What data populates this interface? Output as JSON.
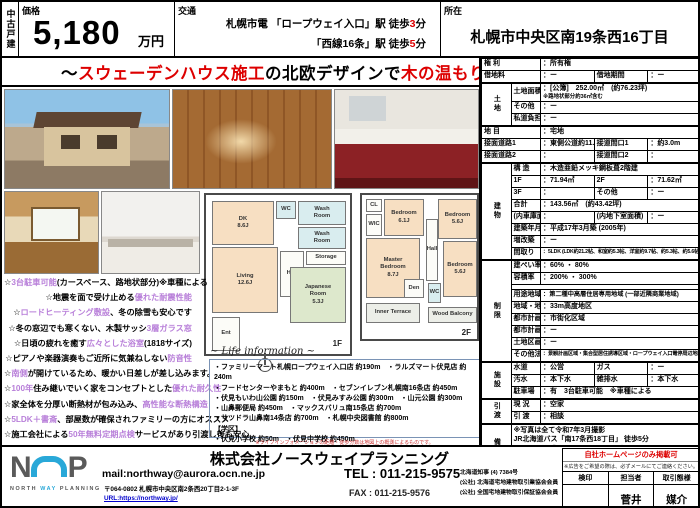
{
  "header": {
    "property_type": "中古戸建",
    "price": {
      "label": "価格",
      "value": "5,180",
      "unit": "万円"
    },
    "access": {
      "label": "交通",
      "lines": [
        [
          [
            "札幌市電 「ロープウェイ入口」駅 徒歩",
            ""
          ],
          [
            "3",
            "r"
          ],
          [
            "分",
            ""
          ]
        ],
        [
          [
            "「西線16条」駅 徒歩",
            ""
          ],
          [
            "5",
            "r"
          ],
          [
            "分",
            ""
          ]
        ]
      ]
    },
    "location": {
      "label": "所在",
      "value": "札幌市中央区南19条西16丁目"
    }
  },
  "banner": [
    [
      "～",
      ""
    ],
    [
      "スウェーデンハウス施工",
      "r"
    ],
    [
      "の北欧デザインで",
      ""
    ],
    [
      "木の温もり",
      "r"
    ],
    [
      "を感じられる邸宅～",
      ""
    ]
  ],
  "floorplan": {
    "f1": {
      "label": "1F",
      "rooms": {
        "dk": "DK\n8.6J",
        "wash1": "Wash\nRoom",
        "wc": "WC",
        "wash2": "Wash\nRoom",
        "living": "Living\n12.6J",
        "hall": "Hall",
        "storage": "Storage",
        "japanese": "Japanese\nRoom\n5.3J",
        "ent": "Ent"
      }
    },
    "f2": {
      "label": "2F",
      "rooms": {
        "cl": "CL",
        "wic": "WIC",
        "bed1": "Bedroom\n6.1J",
        "bed2": "Bedroom\n5.6J",
        "hall": "Hall",
        "master": "Master\nBedroom\n8.7J",
        "den": "Den",
        "wc": "WC",
        "bed3": "Bedroom\n5.6J",
        "terrace": "Inner Terrace",
        "balcony": "Wood Balcony"
      }
    }
  },
  "features": [
    [
      [
        "☆",
        ""
      ],
      [
        "3台駐車可能",
        "v"
      ],
      [
        "(カースペース、路地状部分)※車種による",
        ""
      ]
    ],
    [
      [
        "☆地震を面で受け止める",
        ""
      ],
      [
        "優れた耐震性能",
        "v"
      ]
    ],
    [
      [
        "☆",
        ""
      ],
      [
        "ロードヒーティング敷設",
        "v"
      ],
      [
        "、冬の除雪も安心です",
        ""
      ]
    ],
    [
      [
        "☆冬の窓辺でも寒くない、木製サッシ",
        ""
      ],
      [
        "3層ガラス窓",
        "v"
      ]
    ],
    [
      [
        "☆日頃の疲れを癒す",
        ""
      ],
      [
        "広々とした浴室",
        "v"
      ],
      [
        "(1818サイズ)",
        ""
      ]
    ],
    [
      [
        "☆ピアノや楽器演奏もご近所に気兼ねしない",
        ""
      ],
      [
        "防音性",
        "v"
      ]
    ],
    [
      [
        "☆",
        ""
      ],
      [
        "南側",
        "v"
      ],
      [
        "が開けているため、暖かい日差しが差し込みます。",
        ""
      ]
    ],
    [
      [
        "☆",
        ""
      ],
      [
        "100年",
        "v"
      ],
      [
        "住み継いでいく家をコンセプトとした",
        ""
      ],
      [
        "優れた耐久性",
        "v"
      ]
    ],
    [
      [
        "☆家全体を分厚い断熱材が包み込み、",
        ""
      ],
      [
        "高性能な断熱構造",
        "v"
      ]
    ],
    [
      [
        "☆",
        ""
      ],
      [
        "5LDK＋書斎",
        "v"
      ],
      [
        "、部屋数が確保されファミリーの方にオススメ",
        ""
      ]
    ],
    [
      [
        "☆施工会社による",
        ""
      ],
      [
        "50年無料定期点検",
        "v"
      ],
      [
        "サービスがあり引渡し後も安心",
        ""
      ]
    ]
  ],
  "life": {
    "title": "~ Life information ~",
    "lines": [
      "・ファミリーマート札幌ロープウェイ入口店 約190m　・ラルズマート伏見店 約240m",
      "・フードセンターやまもと 約400m　・セブンイレブン札幌南16条店 約450m",
      "・伏見もいわ山公園 約150m　・伏見みすみ公園 約300m　・山元公園 約300m",
      "・山鼻郵便局 約450m　・マックスバリュ南15条店 約700m",
      "・サツドラ山鼻南14条店 約700m　・札幌中央図書館 約800m",
      "【学区】",
      "・伏見小学校 約50m　・伏見中学校 約450m"
    ],
    "disclaimer": "※ライフインフォメーションの距離・徒歩分数は地図上の概測によるものです。"
  },
  "spec": {
    "rows": [
      {
        "l": "権 利",
        "v": "所有権"
      },
      {
        "l": "借地料",
        "v": "ー",
        "l2": "借地期間",
        "v2": "ー"
      },
      {
        "g": "土地",
        "gs": 3,
        "sec": true,
        "l": "土地面積",
        "v": "[公簿]　252.00㎡　(約76.23坪)",
        "note": "※路地状部分約36㎡含む"
      },
      {
        "ig": true,
        "l": "その他",
        "v": "ー"
      },
      {
        "ig": true,
        "l": "私道負担面積",
        "v": "ー"
      },
      {
        "sec": true,
        "l": "地 目",
        "v": "宅地"
      },
      {
        "l": "接面道路1",
        "v": "東側公道約11.0m",
        "l2": "接道間口1",
        "v2": "約3.0m"
      },
      {
        "l": "接面道路2",
        "v": "",
        "l2": "接道間口2",
        "v2": ""
      },
      {
        "g": "建物",
        "gs": 8,
        "sec": true,
        "l": "構 造",
        "v": "木造亜鉛メッキ鋼板葺2階建"
      },
      {
        "ig": true,
        "l": "1F",
        "v": "71.94㎡",
        "l2": "2F",
        "v2": "71.62㎡"
      },
      {
        "ig": true,
        "l": "3F",
        "v": "",
        "l2": "その他",
        "v2": "ー"
      },
      {
        "ig": true,
        "l": "合計",
        "v": "143.56㎡　(約43.42坪)"
      },
      {
        "ig": true,
        "l": "(内車庫面積)",
        "v": "",
        "l2": "(内地下室面積)",
        "v2": "ー"
      },
      {
        "ig": true,
        "l": "建築年月",
        "v": "平成17年3月築 (2005年)"
      },
      {
        "ig": true,
        "l": "増改築",
        "v": "ー"
      },
      {
        "ig": true,
        "cls": "tiny",
        "l": "間取り",
        "v": "5LDK (LDK約21.2帖、和室約5.3帖、洋室約9.7帖、約5.3帖、約5.6帖×2)"
      },
      {
        "g": "制限",
        "gs": 9,
        "sec": true,
        "l": "建ぺい率",
        "v": "60% ・ 80%"
      },
      {
        "ig": true,
        "l": "容積率",
        "v": "200% ・ 300%"
      },
      {
        "ig": true,
        "spacer": true
      },
      {
        "ig": true,
        "cls": "sm",
        "l": "用途地域",
        "v": "第二種中高層住居専用地域 (一部近隣商業地域)"
      },
      {
        "ig": true,
        "l": "地域・地区",
        "v": "33m高度地区"
      },
      {
        "ig": true,
        "l": "都市計画区域",
        "v": "市街化区域"
      },
      {
        "ig": true,
        "l": "都市計画道路",
        "v": "ー"
      },
      {
        "ig": true,
        "l": "土地区画整理",
        "v": "ー"
      },
      {
        "ig": true,
        "cls": "tiny",
        "l": "その他法令上の制限",
        "v": "景観計画区域・集合型居住誘導区域・ロープウェイ入口電停周辺地区"
      },
      {
        "g": "施設",
        "gs": 3,
        "sec": true,
        "l": "水道",
        "v": "公営",
        "l2": "ガス",
        "v2": "ー"
      },
      {
        "ig": true,
        "l": "汚水",
        "v": "本下水",
        "l2": "雑排水",
        "v2": "本下水"
      },
      {
        "ig": true,
        "l": "駐車場",
        "v": "有　3台駐車可能　※車種による"
      },
      {
        "g": "引渡",
        "gs": 2,
        "sec": true,
        "l": "現 況",
        "v": "空家"
      },
      {
        "ig": true,
        "l": "引 渡",
        "v": "相談"
      },
      {
        "g": "備考",
        "gs": 2,
        "sec": true,
        "full": "※写真は全て令和7年3月撮影\nJR北海道バス「南17条西18丁目」 徒歩5分\n　　東西線「円山公園」駅まで乗車17分"
      },
      {
        "ig": true,
        "sec": true,
        "full": "給湯・暖房設備：灯油セントラル"
      }
    ]
  },
  "footer": {
    "company": "株式会社ノースウェイプランニング",
    "mail": "mail:northway@aurora.ocn.ne.jp",
    "postal": "〒064-0802 札幌市中央区南2条西20丁目2-1-3F",
    "url": "URL:https://northway.jp/",
    "tel": "TEL : 011-215-9575",
    "fax": "FAX : 011-215-9576",
    "licenses": [
      "北海道知事 (4) 7384号",
      "(公社) 北海道宅地建物取引業協会会員",
      "(公社) 全国宅地建物取引保証協会会員"
    ],
    "stamp": {
      "notice": "自社ホームページのみ掲載可",
      "note": "※広告をご希望の際は、必ずメールにてご連絡ください。",
      "col1": "検印",
      "col2": "担当者",
      "col3": "取引態様",
      "val1": "",
      "val2": "菅井",
      "val3": "媒介"
    },
    "logo": {
      "n": "N",
      "p": "P",
      "w1": "NORTH ",
      "w2": "WAY",
      "w3": " PLANNING"
    }
  }
}
